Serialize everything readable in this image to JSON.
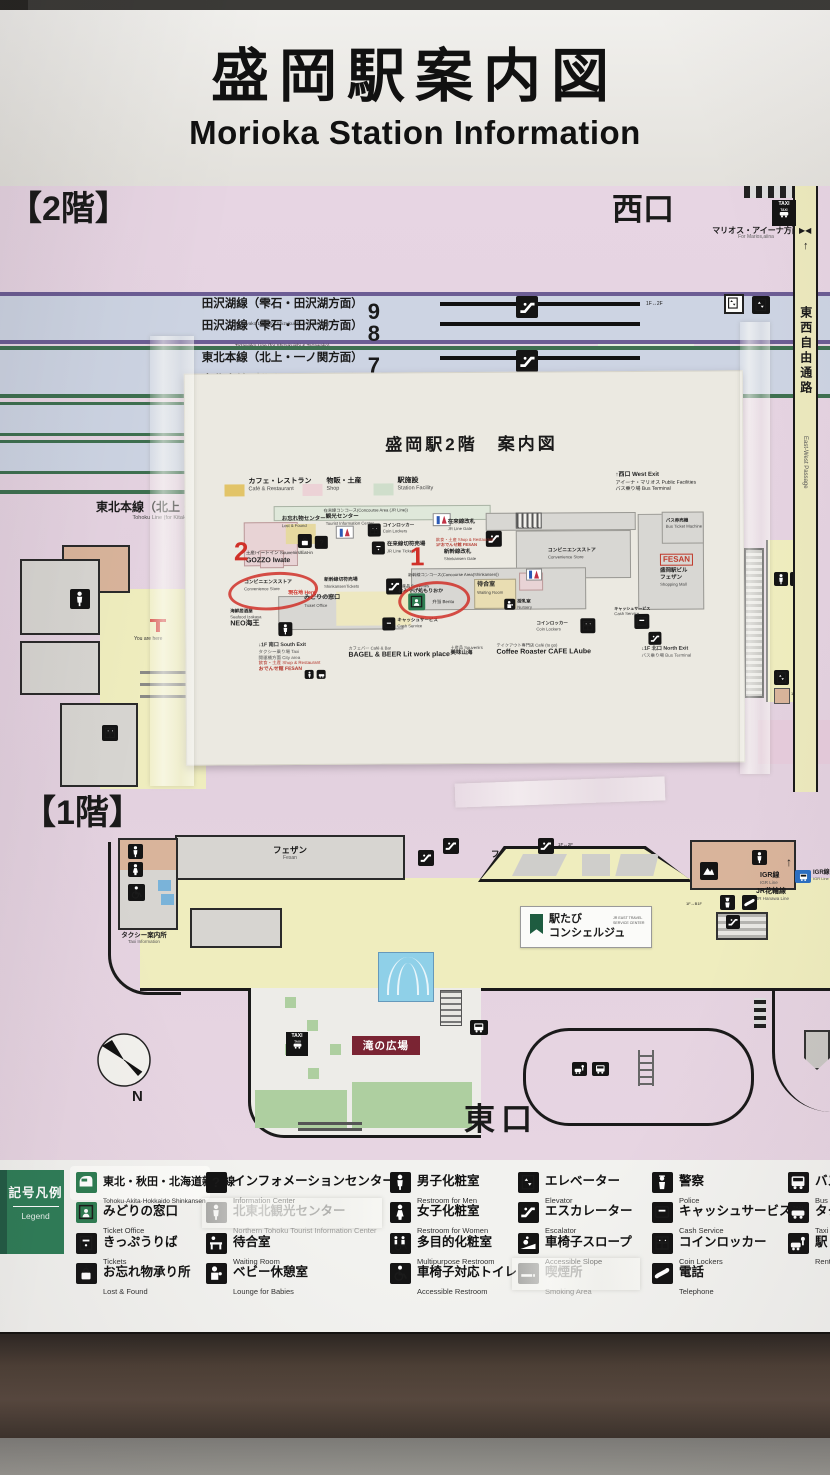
{
  "glyphs": {
    "up": "↑",
    "bowtie": "▶◀"
  },
  "header": {
    "title_jp": "盛岡駅案内図",
    "title_en": "Morioka Station Information"
  },
  "floor2": {
    "label": "【2階】",
    "west_exit": "西口",
    "marios_jp": "マリオス・アイーナ方面",
    "marios_en": "For Marios,aiina",
    "passage_jp": "東西自由通路",
    "passage_en": "East-West Passage",
    "taxi": "TAXI",
    "lift": "1F↔2F",
    "lift_b1f": "1F↔B1F",
    "you_are_here": "You are here",
    "platforms": [
      {
        "jp": "田沢湖線（雫石・田沢湖方面）",
        "en": "Tazawako Line (for Shizukuishi & Tazawako)",
        "num": "9"
      },
      {
        "jp": "田沢湖線（雫石・田沢湖方面）",
        "en": "Tazawako Line (for Shizukuishi & Tazawako)",
        "num": "8"
      },
      {
        "jp": "東北本線（北上・一ノ関方面）",
        "en": "Tohoku Line (for Kitakami & Ichinoseki)",
        "num": "7"
      },
      {
        "jp": "東北本線（北上・一ノ関方面）",
        "en": "Tohoku Line (for Kitakami & Ichinoseki)",
        "num": "6"
      }
    ],
    "side_line_jp": "東北本線（北上・一ノ関方面）",
    "side_line_en": "Tohoku Line (for Kitakami & Ichinoseki)"
  },
  "paper": {
    "title": "盛岡駅2階　案内図",
    "legend": [
      {
        "jp": "カフェ・レストラン",
        "en": "Café & Restaurant",
        "color": "#e2c468"
      },
      {
        "jp": "物販・土産",
        "en": "Shop",
        "color": "#ecd2d6"
      },
      {
        "jp": "駅施設",
        "en": "Station Facility",
        "color": "#cfdecb"
      }
    ],
    "west_note": {
      "l1": "↑西口  West Exit",
      "l2": "アイーナ・マリオス  Public Facilities",
      "l3": "バス乗り場  Bus Terminal"
    },
    "labels": {
      "jr_concourse": "在来線コンコース(Concourse Area (JR Line))",
      "lost_found_jp": "お忘れ物センター",
      "lost_found_en": "Lost & Found",
      "tourist_jp": "観光センター",
      "tourist_en": "Tourist Information Center",
      "jr_gate_jp": "在来線改札",
      "jr_gate_en": "JR Line Gate",
      "jr_tickets_jp": "在来線切符売場",
      "jr_tickets_en": "JR Line Tickets",
      "coin_jp": "コインロッカー",
      "coin_en": "Coin Lockers",
      "conv_jp": "コンビニエンスストア",
      "conv_en": "Convenience Store",
      "gozzo_cat": "土産/イートイン Souvenirs/Eat-in",
      "gozzo": "GOZZO Iwate",
      "here_jp": "現在地",
      "here_en": "Here",
      "shink_tickets_jp": "新幹線切符売場",
      "shink_tickets_en": "ShinkansenTickets",
      "midori_jp": "みどりの窓口",
      "midori_en": "Ticket Office",
      "shink_gate_jp": "新幹線改札",
      "shink_gate_en": "Shinkansen Gate",
      "shink_concourse": "新幹線コンコース(Concourse Area(Shinkansen))",
      "omiyage_cat": "土産品 Souvenirs",
      "omiyage": "おみやげ処もりおか",
      "bento": "弁当 Bento",
      "seafood_jp": "海鮮居酒屋",
      "seafood_en": "Seafood Izakaya",
      "neo": "NEO海王",
      "waiting_jp": "待合室",
      "waiting_en": "Waiting Room",
      "nursery_jp": "授乳室",
      "nursery_en": "Nursery",
      "cash_jp": "キャッシュサービス",
      "cash_en": "Cash Service",
      "bus_ticket_jp": "バス券売機",
      "bus_ticket_en": "Bus Ticket Machine",
      "fesan_logo": "FESAN",
      "fesan_b1": "盛岡駅ビル",
      "fesan_b2": "フェザン",
      "fesan_b3": "Shopping Mall",
      "shop_note1": "飲食・土産 Shop & Restaurant",
      "shop_note2": "1Fおでんせ館 FESAN"
    },
    "south": {
      "l1": "↓1F 南口  South Exit",
      "l2": "タクシー乗り場  Taxi",
      "l3": "開運橋方面  City area",
      "l4": "飲食・土産 Shop & Restaurant",
      "l5": "おでんせ館 FESAN"
    },
    "cafe_bar_jp": "カフェバー Café & Bar",
    "cafe_bar": "BAGEL & BEER Lit work place",
    "souvenir2_jp": "土産品 Souvenirs",
    "souvenir2": "美味山海",
    "togo_jp": "テイクアウト専門店 Café (to go)",
    "togo": "Coffee  Roaster CAFE LAube",
    "north": {
      "l1": "↓1F 北口  North Exit",
      "l2": "バス乗り場  Bus Terminal"
    },
    "ann": {
      "n1": "1",
      "n2": "2"
    }
  },
  "floor1": {
    "label": "【1階】",
    "fesan_jp": "フェザン",
    "fesan_en": "Fesan",
    "taxi_info_jp": "タクシー案内所",
    "taxi_info_en": "Taxi Information",
    "ekitabi1": "駅たび",
    "ekitabi2": "コンシェルジュ",
    "ekitabi_en": "JR EAST TRAVEL SERVICE CENTER",
    "igr_jp": "IGR線",
    "igr_en": "IGR Line",
    "hanawa_jp": "JR花輪線",
    "hanawa_en": "JR Hanawa Line",
    "taki": "滝の広場",
    "east_exit": "東口",
    "compass": "N",
    "taxi": "TAXI",
    "lift": "1F↔2F",
    "lift_b1f": "1F↔B1F",
    "up_arrow": "↑"
  },
  "legend": {
    "box_jp": "記号凡例",
    "box_en": "Legend",
    "columns": [
      {
        "items": [
          {
            "icon": "shinkansen-icon",
            "jp": "東北・秋田・北海道新幹線",
            "en": "Tohoku·Akita·Hokkaido Shinkansen"
          },
          {
            "icon": "ticket-office-icon",
            "jp": "みどりの窓口",
            "en": "Ticket Office"
          },
          {
            "icon": "tickets-icon",
            "jp": "きっぷうりば",
            "en": "Tickets"
          },
          {
            "icon": "lost-and-found-icon",
            "jp": "お忘れ物承り所",
            "en": "Lost & Found"
          }
        ]
      },
      {
        "items": [
          {
            "icon": "information-icon",
            "jp": "インフォメーションセンター",
            "en": "Information Center"
          },
          {
            "icon": "tourist-center-icon",
            "jp": "北東北観光センター",
            "en": "Northern Tohoku Tourist Information Center"
          },
          {
            "icon": "waiting-room-icon",
            "jp": "待合室",
            "en": "Waiting Room"
          },
          {
            "icon": "baby-lounge-icon",
            "jp": "ベビー休憩室",
            "en": "Lounge for Babies"
          }
        ]
      },
      {
        "items": [
          {
            "icon": "mens-restroom-icon",
            "jp": "男子化粧室",
            "en": "Restroom for Men"
          },
          {
            "icon": "womens-restroom-icon",
            "jp": "女子化粧室",
            "en": "Restroom for Women"
          },
          {
            "icon": "multipurpose-restroom-icon",
            "jp": "多目的化粧室",
            "en": "Multipurpose Restroom"
          },
          {
            "icon": "accessible-restroom-icon",
            "jp": "車椅子対応トイレ",
            "en": "Accessible Restroom"
          }
        ]
      },
      {
        "items": [
          {
            "icon": "elevator-icon",
            "jp": "エレベーター",
            "en": "Elevator"
          },
          {
            "icon": "escalator-icon",
            "jp": "エスカレーター",
            "en": "Escalator"
          },
          {
            "icon": "accessible-slope-icon",
            "jp": "車椅子スロープ",
            "en": "Accessible Slope"
          },
          {
            "icon": "smoking-area-icon",
            "jp": "喫煙所",
            "en": "Smoking Area"
          }
        ]
      },
      {
        "items": [
          {
            "icon": "police-icon",
            "jp": "警察",
            "en": "Police"
          },
          {
            "icon": "cash-service-icon",
            "jp": "キャッシュサービス",
            "en": "Cash Service"
          },
          {
            "icon": "coin-lockers-icon",
            "jp": "コインロッカー",
            "en": "Coin Lockers"
          },
          {
            "icon": "telephone-icon",
            "jp": "電話",
            "en": "Telephone"
          }
        ]
      },
      {
        "items": [
          {
            "icon": "bus-icon",
            "jp": "バス",
            "en": "Bus"
          },
          {
            "icon": "taxi-icon",
            "jp": "タク",
            "en": "Taxi"
          },
          {
            "icon": "rent-a-car-icon",
            "jp": "駅レ",
            "en": "Rent-"
          }
        ]
      }
    ]
  }
}
